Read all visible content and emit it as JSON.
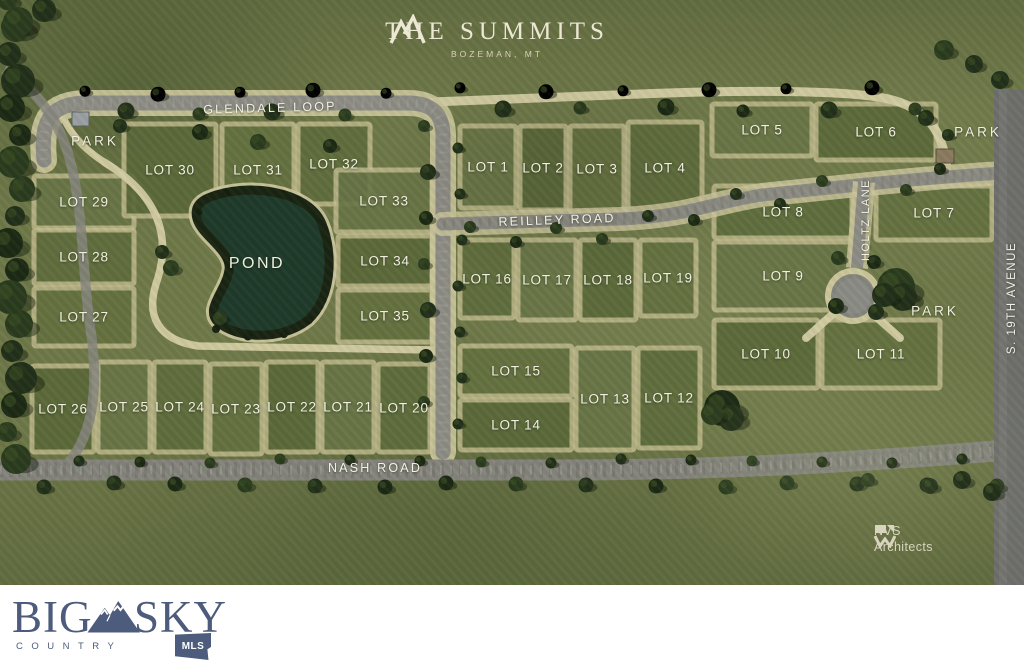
{
  "header": {
    "name": "THE SUMMITS",
    "location": "BOZEMAN, MT"
  },
  "roads": {
    "glendale_loop": "GLENDALE LOOP",
    "reilley_road": "REILLEY ROAD",
    "nash_road": "NASH ROAD",
    "holtz_lane": "HOLTZ LANE",
    "s_19th_avenue": "S. 19TH AVENUE"
  },
  "features": {
    "pond": "POND",
    "park_top_left": "PARK",
    "park_top_right": "PARK",
    "park_right": "PARK"
  },
  "lots": [
    {
      "id": 1,
      "label": "LOT 1"
    },
    {
      "id": 2,
      "label": "LOT 2"
    },
    {
      "id": 3,
      "label": "LOT 3"
    },
    {
      "id": 4,
      "label": "LOT 4"
    },
    {
      "id": 5,
      "label": "LOT 5"
    },
    {
      "id": 6,
      "label": "LOT 6"
    },
    {
      "id": 7,
      "label": "LOT 7"
    },
    {
      "id": 8,
      "label": "LOT 8"
    },
    {
      "id": 9,
      "label": "LOT 9"
    },
    {
      "id": 10,
      "label": "LOT 10"
    },
    {
      "id": 11,
      "label": "LOT 11"
    },
    {
      "id": 12,
      "label": "LOT 12"
    },
    {
      "id": 13,
      "label": "LOT 13"
    },
    {
      "id": 14,
      "label": "LOT 14"
    },
    {
      "id": 15,
      "label": "LOT 15"
    },
    {
      "id": 16,
      "label": "LOT 16"
    },
    {
      "id": 17,
      "label": "LOT 17"
    },
    {
      "id": 18,
      "label": "LOT 18"
    },
    {
      "id": 19,
      "label": "LOT 19"
    },
    {
      "id": 20,
      "label": "LOT 20"
    },
    {
      "id": 21,
      "label": "LOT 21"
    },
    {
      "id": 22,
      "label": "LOT 22"
    },
    {
      "id": 23,
      "label": "LOT 23"
    },
    {
      "id": 24,
      "label": "LOT 24"
    },
    {
      "id": 25,
      "label": "LOT 25"
    },
    {
      "id": 26,
      "label": "LOT 26"
    },
    {
      "id": 27,
      "label": "LOT 27"
    },
    {
      "id": 28,
      "label": "LOT 28"
    },
    {
      "id": 29,
      "label": "LOT 29"
    },
    {
      "id": 30,
      "label": "LOT 30"
    },
    {
      "id": 31,
      "label": "LOT 31"
    },
    {
      "id": 32,
      "label": "LOT 32"
    },
    {
      "id": 33,
      "label": "LOT 33"
    },
    {
      "id": 34,
      "label": "LOT 34"
    },
    {
      "id": 35,
      "label": "LOT 35"
    }
  ],
  "branding": {
    "nvs_line1": "NVS",
    "nvs_line2": "Architects",
    "big": "BIG",
    "sky": "SKY",
    "country": "COUNTRY",
    "mls": "MLS"
  },
  "colors": {
    "field_green": "#6e7848",
    "lot_green": "#5d6b3a",
    "path_tan": "#ccc69c",
    "road_gravel": "#8c8c84",
    "road_asphalt": "#6e6f6b",
    "pond_dark_green": "#1f3a2a",
    "label_cream": "#f1efe0",
    "logo_slate_blue": "#4d5c7c"
  }
}
